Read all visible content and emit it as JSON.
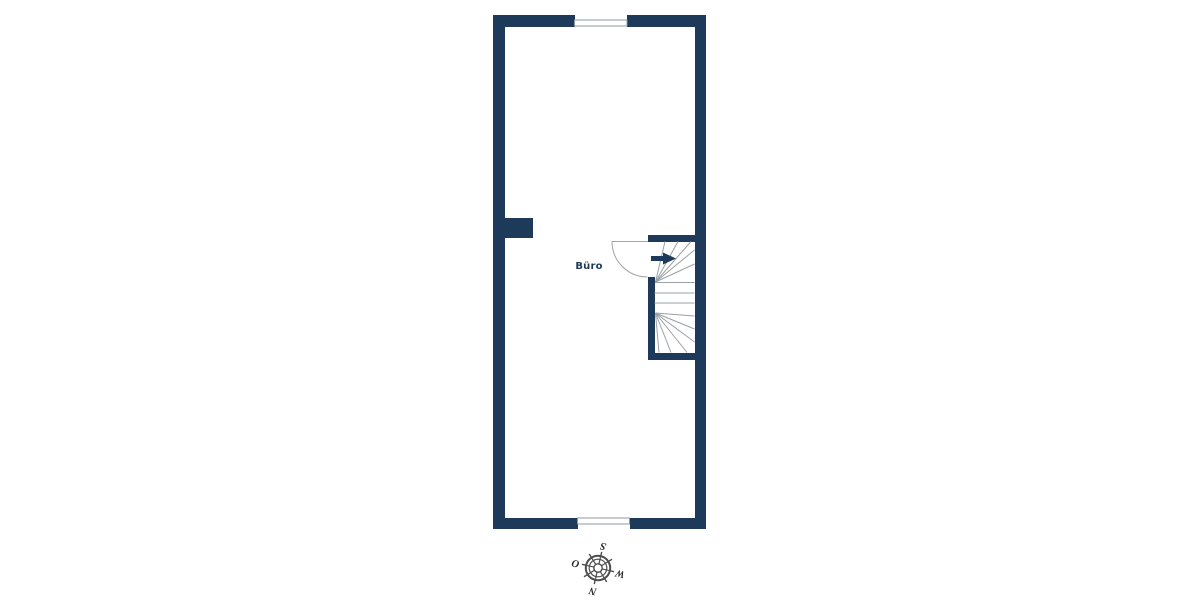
{
  "floor_plan": {
    "room_label": "Büro",
    "compass": {
      "north_label": "N",
      "east_label": "O",
      "south_label": "S",
      "west_label": "W",
      "rotation_note": "compass rotated ~193°, south pointing up"
    },
    "features": [
      "winder-staircase",
      "door-swing",
      "top-window",
      "bottom-window",
      "wall-pier"
    ]
  },
  "colors": {
    "wall": "#1e3a5a",
    "stair_line": "#9aa0a4",
    "door_line": "#a3a3a3",
    "window_line": "#8f989e",
    "compass_stroke": "#4d4d4d",
    "compass_text": "#2b2b2b",
    "label_text": "#1e3a5a",
    "background": "#ffffff"
  }
}
